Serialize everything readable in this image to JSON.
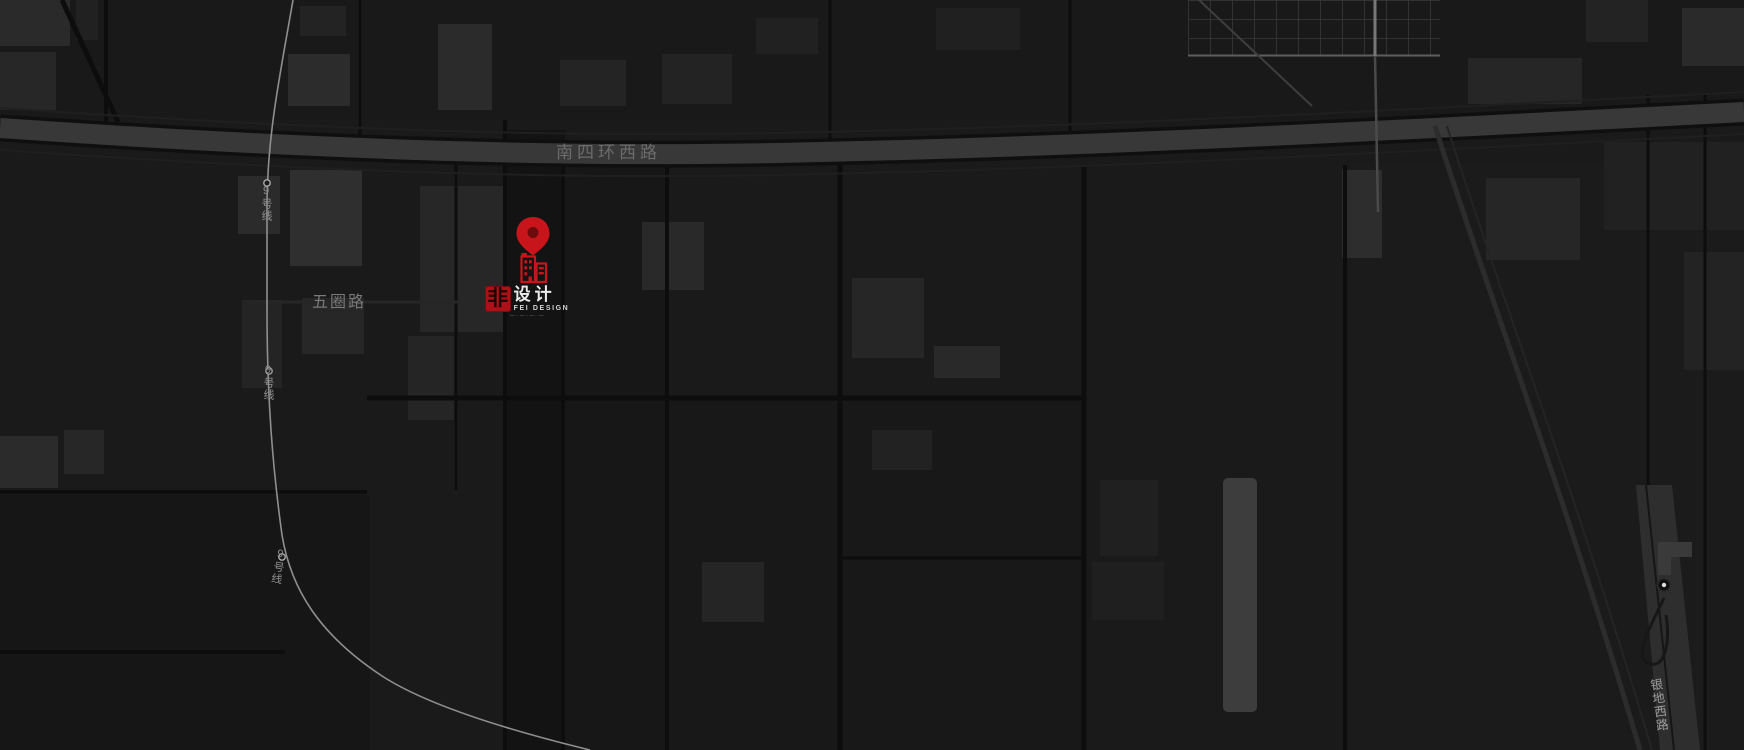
{
  "map": {
    "labels": {
      "ring_road": "南四环西路",
      "wuquan_road": "五圈路",
      "subway_line": "9号线",
      "yindi_road": "银地西路"
    }
  },
  "marker": {
    "logo": {
      "mark": "非",
      "name_cn": "设计",
      "name_en": "FEI DESIGN",
      "tagline": "— ·· — ·· — ·· —"
    }
  },
  "colors": {
    "accent_red": "#c7151b",
    "map_background": "#191919",
    "highway_fill": "#383838",
    "subway_line": "#8f8f8f"
  }
}
